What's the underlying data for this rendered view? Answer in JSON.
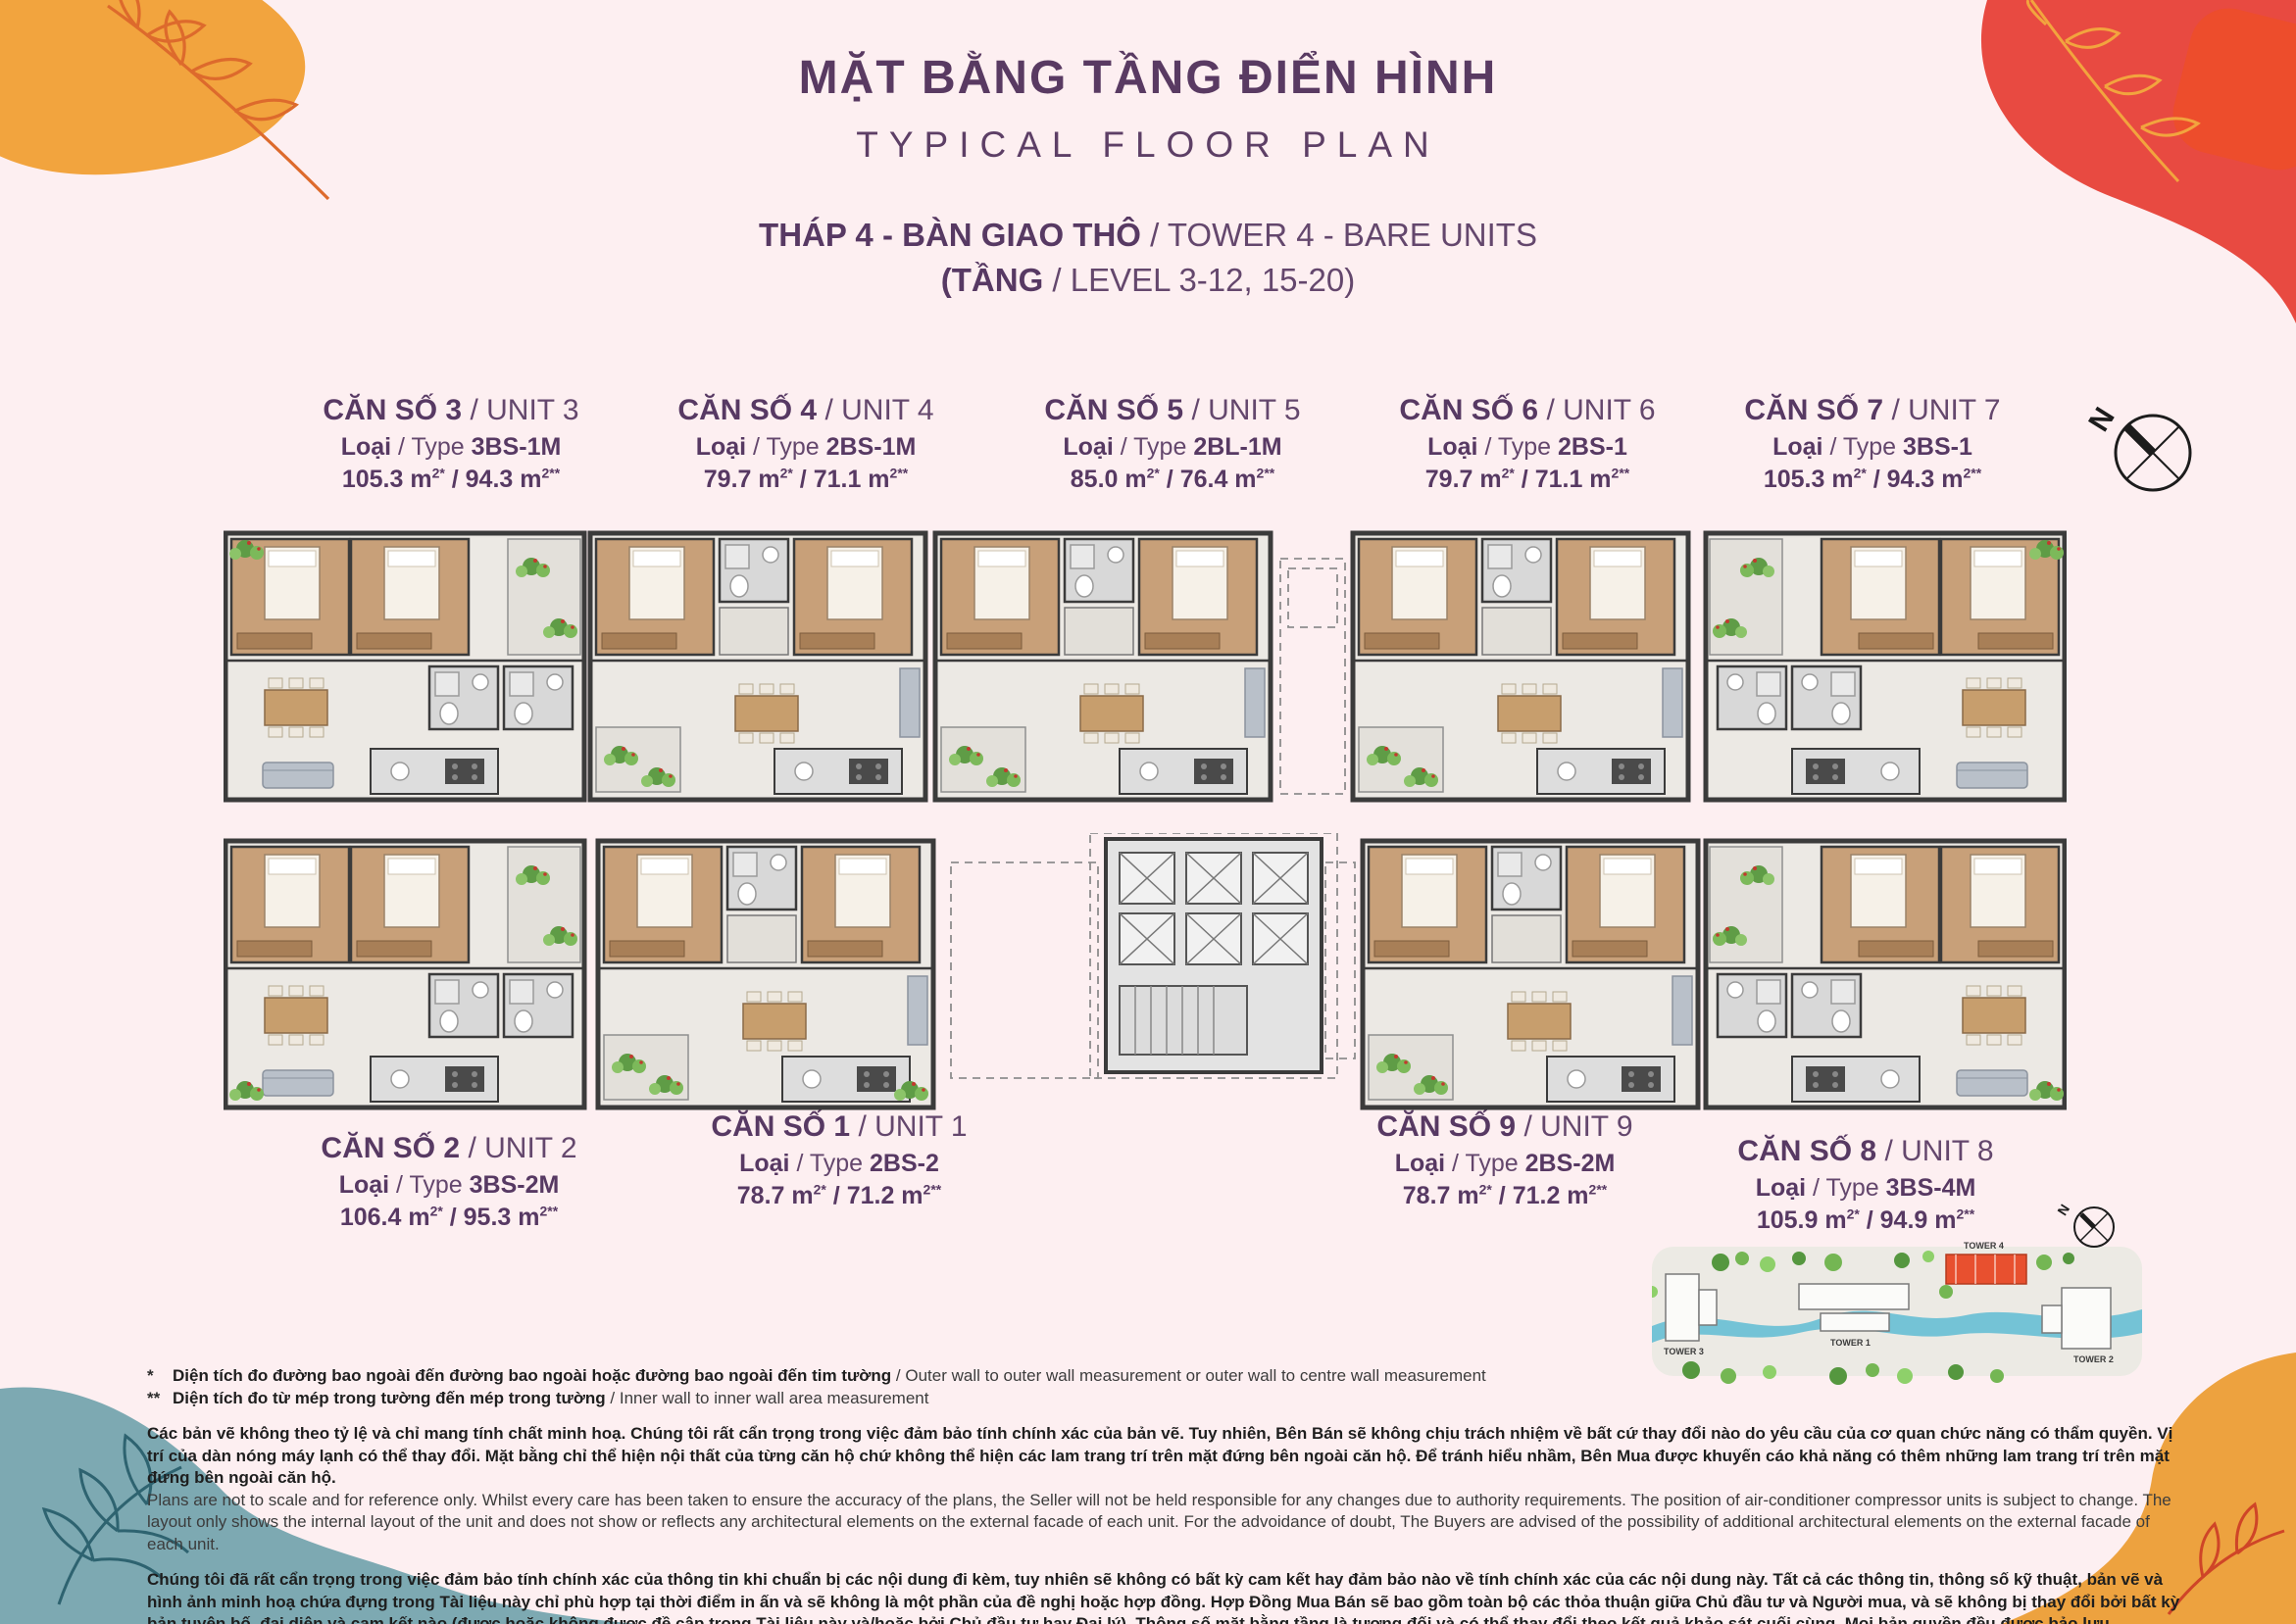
{
  "header": {
    "title_vn": "MẶT BẰNG TẦNG ĐIỂN HÌNH",
    "title_en": "TYPICAL FLOOR PLAN",
    "tower_bold": "THÁP 4 - BÀN GIAO THÔ",
    "tower_rest": " / TOWER 4 - BARE UNITS",
    "level_bold": "(TẦNG",
    "level_rest": " / LEVEL 3-12, 15-20)"
  },
  "labels": {
    "name_sep": " / ",
    "loai": "Loại",
    "type_mid": " / Type ",
    "area_sep": " / "
  },
  "units": [
    {
      "num": "CĂN SỐ 3",
      "en": "UNIT 3",
      "code": "3BS-1M",
      "a1": "105.3 m",
      "s1": "2*",
      "a2": "94.3 m",
      "s2": "2**"
    },
    {
      "num": "CĂN SỐ 4",
      "en": "UNIT 4",
      "code": "2BS-1M",
      "a1": "79.7 m",
      "s1": "2*",
      "a2": "71.1 m",
      "s2": "2**"
    },
    {
      "num": "CĂN SỐ 5",
      "en": "UNIT 5",
      "code": "2BL-1M",
      "a1": "85.0 m",
      "s1": "2*",
      "a2": "76.4 m",
      "s2": "2**"
    },
    {
      "num": "CĂN SỐ 6",
      "en": "UNIT 6",
      "code": "2BS-1",
      "a1": "79.7 m",
      "s1": "2*",
      "a2": "71.1 m",
      "s2": "2**"
    },
    {
      "num": "CĂN SỐ 7",
      "en": "UNIT 7",
      "code": "3BS-1",
      "a1": "105.3 m",
      "s1": "2*",
      "a2": "94.3 m",
      "s2": "2**"
    },
    {
      "num": "CĂN SỐ 2",
      "en": "UNIT 2",
      "code": "3BS-2M",
      "a1": "106.4 m",
      "s1": "2*",
      "a2": "95.3 m",
      "s2": "2**"
    },
    {
      "num": "CĂN SỐ 1",
      "en": "UNIT 1",
      "code": "2BS-2",
      "a1": "78.7 m",
      "s1": "2*",
      "a2": "71.2 m",
      "s2": "2**"
    },
    {
      "num": "CĂN SỐ 9",
      "en": "UNIT 9",
      "code": "2BS-2M",
      "a1": "78.7 m",
      "s1": "2*",
      "a2": "71.2 m",
      "s2": "2**"
    },
    {
      "num": "CĂN SỐ 8",
      "en": "UNIT 8",
      "code": "3BS-4M",
      "a1": "105.9 m",
      "s1": "2*",
      "a2": "94.9 m",
      "s2": "2**"
    }
  ],
  "compass": {
    "n": "N"
  },
  "site_plan": {
    "labels": [
      "TOWER 3",
      "TOWER 1",
      "TOWER 4",
      "TOWER 2"
    ]
  },
  "footnotes": [
    {
      "sym": "*",
      "vn": "Diện tích đo đường bao ngoài đến đường bao ngoài hoặc đường bao ngoài đến tim tường",
      "en": " / Outer wall to outer wall measurement or outer wall to centre wall measurement"
    },
    {
      "sym": "**",
      "vn": "Diện tích đo từ mép trong tường đến mép trong tường",
      "en": " / Inner wall to inner wall area measurement"
    }
  ],
  "disclaimers": [
    {
      "vn": "Các bản vẽ không theo tỷ lệ và chỉ mang tính chất minh hoạ. Chúng tôi rất cẩn trọng trong việc đảm bảo tính chính xác của bản vẽ. Tuy nhiên, Bên Bán sẽ không chịu trách nhiệm về bất cứ thay đổi nào do yêu cầu của cơ quan chức năng có thẩm quyền. Vị trí của dàn nóng máy lạnh có thể thay đổi. Mặt bằng chỉ thể hiện nội thất của từng căn hộ chứ không thể hiện các lam trang trí trên mặt đứng bên ngoài căn hộ. Để tránh hiểu nhầm, Bên Mua được khuyến cáo khả năng có thêm những lam trang trí trên mặt đứng bên ngoài căn hộ.",
      "en": "Plans are not to scale and for reference only. Whilst every care has been taken to ensure the accuracy of the plans, the Seller will not be held responsible for any changes due to authority requirements. The position of air-conditioner compressor units is subject to change. The layout only shows the internal layout of the unit and does not show or reflects any architectural elements on the external facade of each unit. For the advoidance of doubt, The Buyers are advised of the possibility of additional architectural elements on the external facade of each unit."
    },
    {
      "vn": "Chúng tôi đã rất cẩn trọng trong việc đảm bảo tính chính xác của thông tin khi chuẩn bị các nội dung đi kèm, tuy nhiên sẽ không có bất kỳ cam kết hay đảm bảo nào về tính chính xác của các nội dung này. Tất cả các thông tin, thông số kỹ thuật, bản vẽ và hình ảnh minh hoạ chứa đựng trong Tài liệu này chỉ phù hợp tại thời điểm in ấn và sẽ không là một phần của đề nghị hoặc hợp đồng. Hợp Đồng Mua Bán sẽ bao gồm toàn bộ các thỏa thuận giữa Chủ đầu tư và Người mua, và sẽ không bị thay đổi bởi bất kỳ bản tuyên bố, đại diện và cam kết nào (được hoặc không được đề cập trong Tài liệu này và/hoặc bởi Chủ đầu tư hay Đại lý). Thông số mặt bằng tầng là tương đối và có thể thay đổi theo kết quả khảo sát cuối cùng. Mọi bản quyền đều được bảo lưu.",
      "en": "Whilst every care has been taken to ensure accuracy in the preparation of the information contained herein, no warranties whatsoever are given or legal representative is provided in respect thereon. All information, specifications, plans and visual representations contained in the Materials are current only as at the time of printing and shall not form part of the offer or contract. The Sale and Purchase Agreement shall form the entire agreement between the developer and the purchaser and shall in no way be modified by any statements, representations or promises (whether or not contained in the Materials and/or made by the developer or the agent). The floor plans are approximate measurements and are subject to final survey. All rights reserved."
    }
  ],
  "colors": {
    "background": "#fdeff1",
    "title_purple": "#593a62",
    "blob_orange": "#f2a43e",
    "blob_red": "#e84a41",
    "blob_vermillion": "#ed4d2c",
    "blob_teal": "#7da9b2",
    "tower_highlight": "#e8502f",
    "wall": "#3b3b3b",
    "wood": "#c8a079",
    "water": "#74c3d6"
  }
}
